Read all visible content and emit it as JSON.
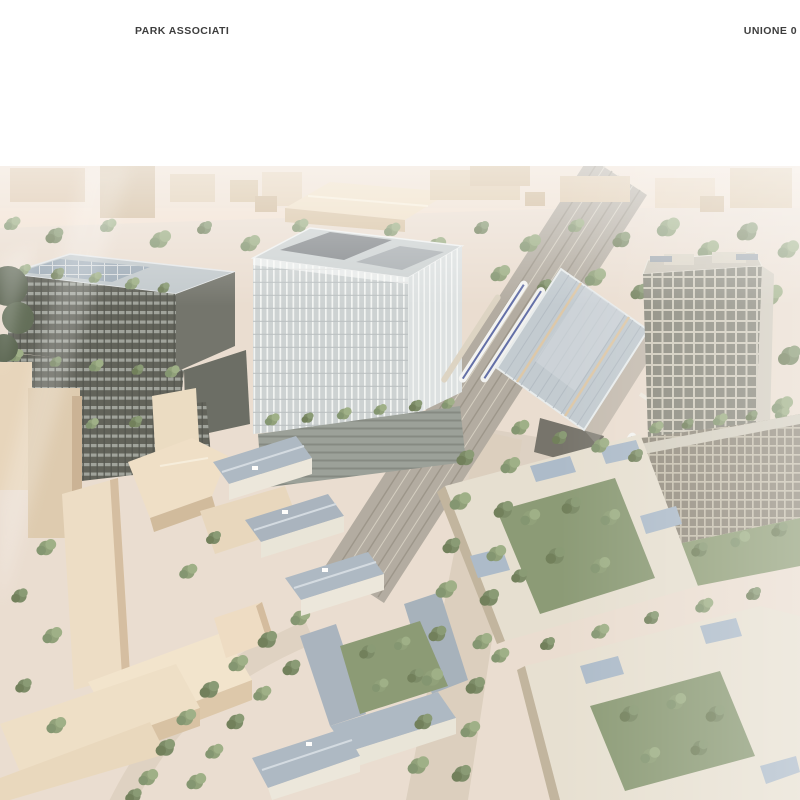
{
  "page": {
    "background": "#ffffff"
  },
  "header": {
    "brand": "PARK ASSOCIATI",
    "project_title": "UNIONE 0",
    "text_color": "#3e3e3e"
  },
  "hero": {
    "alt": "Aerial rendering of the Unione 0 masterplan: dark offices with green terraces, a white glass tower, a striped station canopy over railway tracks with trains, a gridded residential tower and cream courtyard housing blocks with slate solar roofs, set in a beige massing model of the surrounding city under a bright white haze",
    "palette": {
      "context_beige": "#d9c2a3",
      "greenery": "#7d9266",
      "slate_roof": "#a0aebb",
      "cream_facade": "#e3dccc",
      "dark_office": "#43463e",
      "glass_tower": "#c4cccf",
      "station_canopy": "#b8c3cc",
      "ground_road": "#ecdccb",
      "haze": "#ffffff"
    }
  }
}
